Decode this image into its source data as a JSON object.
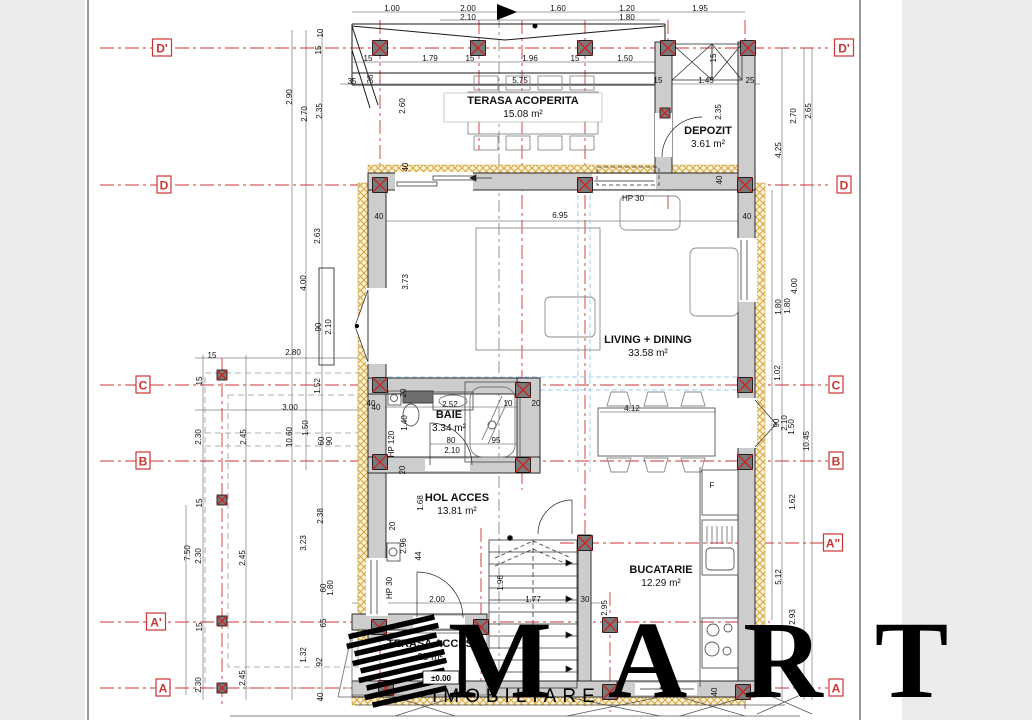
{
  "colors": {
    "grid_red": "#cc3333",
    "wall_gray": "#cdcdcd",
    "hatch_yellow": "#d9a33c",
    "hatch_bg": "#fdf3d6",
    "blue_dash": "#9fc8e8",
    "marker_fill": "#7a7a7a",
    "page_bg": "#ffffff",
    "margin_bg": "#ececec"
  },
  "watermark": {
    "title": "MART",
    "subtitle": "IMOBILIARE"
  },
  "level_marker": "±0.00",
  "grid_rows": [
    {
      "label": "D'",
      "y": 48,
      "x1": 100,
      "x2": 828,
      "lx": 162,
      "rx": 844
    },
    {
      "label": "D",
      "y": 185,
      "x1": 100,
      "x2": 828,
      "lx": 164,
      "rx": 844
    },
    {
      "label": "C",
      "y": 385,
      "x1": 100,
      "x2": 828,
      "lx": 143,
      "rx": 836
    },
    {
      "label": "B",
      "y": 461,
      "x1": 100,
      "x2": 828,
      "lx": 143,
      "rx": 836
    },
    {
      "label": "A\"",
      "y": 543,
      "x1": 560,
      "x2": 828,
      "lx": null,
      "rx": 833
    },
    {
      "label": "A'",
      "y": 622,
      "x1": 100,
      "x2": 770,
      "lx": 156,
      "rx": null
    },
    {
      "label": "A",
      "y": 688,
      "x1": 100,
      "x2": 828,
      "lx": 163,
      "rx": 836
    }
  ],
  "grid_cols": [
    {
      "x": 222,
      "y1": 358,
      "y2": 706
    },
    {
      "x": 380,
      "y1": 20,
      "y2": 706
    },
    {
      "x": 479,
      "y1": 20,
      "y2": 150
    },
    {
      "x": 481,
      "y1": 528,
      "y2": 706
    },
    {
      "x": 522,
      "y1": 20,
      "y2": 490
    },
    {
      "x": 585,
      "y1": 20,
      "y2": 706
    },
    {
      "x": 610,
      "y1": 592,
      "y2": 712
    },
    {
      "x": 668,
      "y1": 20,
      "y2": 210
    },
    {
      "x": 745,
      "y1": 20,
      "y2": 710
    }
  ],
  "rooms": [
    {
      "name": "TERASA ACOPERITA",
      "area": "15.08 m²",
      "x": 523,
      "y": 104
    },
    {
      "name": "DEPOZIT",
      "area": "3.61 m²",
      "x": 708,
      "y": 134
    },
    {
      "name": "LIVING + DINING",
      "area": "33.58 m²",
      "x": 648,
      "y": 343
    },
    {
      "name": "BAIE",
      "area": "3.34 m²",
      "x": 449,
      "y": 418
    },
    {
      "name": "HOL ACCES",
      "area": "13.81 m²",
      "x": 457,
      "y": 501
    },
    {
      "name": "BUCATARIE",
      "area": "12.29 m²",
      "x": 661,
      "y": 573
    },
    {
      "name": "TERASA ACCES",
      "area": "23 m²",
      "x": 430,
      "y": 647
    }
  ],
  "dimensions": [
    {
      "t": "1.00",
      "x": 392,
      "y": 8
    },
    {
      "t": "2.00",
      "x": 468,
      "y": 8
    },
    {
      "t": "2.10",
      "x": 468,
      "y": 17
    },
    {
      "t": "1.60",
      "x": 558,
      "y": 8
    },
    {
      "t": "1.20",
      "x": 627,
      "y": 8
    },
    {
      "t": "1.80",
      "x": 627,
      "y": 17
    },
    {
      "t": "1.95",
      "x": 700,
      "y": 8
    },
    {
      "t": "15",
      "x": 368,
      "y": 58
    },
    {
      "t": "1.79",
      "x": 430,
      "y": 58
    },
    {
      "t": "15",
      "x": 470,
      "y": 58
    },
    {
      "t": "1.96",
      "x": 530,
      "y": 58
    },
    {
      "t": "15",
      "x": 575,
      "y": 58
    },
    {
      "t": "1.50",
      "x": 625,
      "y": 58
    },
    {
      "t": "35",
      "x": 352,
      "y": 81
    },
    {
      "t": "5.75",
      "x": 520,
      "y": 80
    },
    {
      "t": "15",
      "x": 658,
      "y": 80
    },
    {
      "t": "1.45",
      "x": 706,
      "y": 80
    },
    {
      "t": "25",
      "x": 750,
      "y": 80
    },
    {
      "t": "10",
      "x": 320,
      "y": 33,
      "v": true
    },
    {
      "t": "15",
      "x": 318,
      "y": 50,
      "v": true
    },
    {
      "t": "2.90",
      "x": 289,
      "y": 97,
      "v": true
    },
    {
      "t": "2.70",
      "x": 304,
      "y": 114,
      "v": true
    },
    {
      "t": "2.35",
      "x": 319,
      "y": 111,
      "v": true
    },
    {
      "t": "2.60",
      "x": 402,
      "y": 106,
      "v": true
    },
    {
      "t": "36",
      "x": 370,
      "y": 79,
      "v": true
    },
    {
      "t": "40",
      "x": 405,
      "y": 167,
      "v": true
    },
    {
      "t": "2.63",
      "x": 317,
      "y": 236,
      "v": true
    },
    {
      "t": "4.00",
      "x": 303,
      "y": 283,
      "v": true
    },
    {
      "t": "3.73",
      "x": 405,
      "y": 282,
      "v": true
    },
    {
      "t": "90",
      "x": 318,
      "y": 327,
      "v": true
    },
    {
      "t": "2.10",
      "x": 328,
      "y": 327,
      "v": true
    },
    {
      "t": "2.80",
      "x": 293,
      "y": 352
    },
    {
      "t": "1.52",
      "x": 317,
      "y": 386,
      "v": true
    },
    {
      "t": "15",
      "x": 212,
      "y": 355
    },
    {
      "t": "15",
      "x": 199,
      "y": 381,
      "v": true
    },
    {
      "t": "3.00",
      "x": 290,
      "y": 407
    },
    {
      "t": "40",
      "x": 376,
      "y": 407
    },
    {
      "t": "2.30",
      "x": 198,
      "y": 437,
      "v": true
    },
    {
      "t": "2.45",
      "x": 243,
      "y": 437,
      "v": true
    },
    {
      "t": "1.50",
      "x": 305,
      "y": 428,
      "v": true
    },
    {
      "t": "10.60",
      "x": 289,
      "y": 437,
      "v": true
    },
    {
      "t": "60",
      "x": 321,
      "y": 441,
      "v": true
    },
    {
      "t": "90",
      "x": 329,
      "y": 441,
      "v": true
    },
    {
      "t": "15",
      "x": 199,
      "y": 503,
      "v": true
    },
    {
      "t": "2.38",
      "x": 320,
      "y": 516,
      "v": true
    },
    {
      "t": "7.50",
      "x": 187,
      "y": 553,
      "v": true
    },
    {
      "t": "2.30",
      "x": 198,
      "y": 556,
      "v": true
    },
    {
      "t": "2.45",
      "x": 242,
      "y": 558,
      "v": true
    },
    {
      "t": "3.23",
      "x": 303,
      "y": 543,
      "v": true
    },
    {
      "t": "60",
      "x": 323,
      "y": 588,
      "v": true
    },
    {
      "t": "1.80",
      "x": 330,
      "y": 588,
      "v": true
    },
    {
      "t": "65",
      "x": 323,
      "y": 623,
      "v": true
    },
    {
      "t": "15",
      "x": 199,
      "y": 627,
      "v": true
    },
    {
      "t": "1.32",
      "x": 303,
      "y": 655,
      "v": true
    },
    {
      "t": "92",
      "x": 319,
      "y": 662,
      "v": true
    },
    {
      "t": "2.30",
      "x": 198,
      "y": 685,
      "v": true
    },
    {
      "t": "2.45",
      "x": 242,
      "y": 678,
      "v": true
    },
    {
      "t": "40",
      "x": 320,
      "y": 697,
      "v": true
    },
    {
      "t": "40",
      "x": 379,
      "y": 216
    },
    {
      "t": "6.95",
      "x": 560,
      "y": 215
    },
    {
      "t": "HP 30",
      "x": 633,
      "y": 198
    },
    {
      "t": "40",
      "x": 719,
      "y": 180,
      "v": true
    },
    {
      "t": "40",
      "x": 747,
      "y": 216
    },
    {
      "t": "15",
      "x": 713,
      "y": 58,
      "v": true
    },
    {
      "t": "2.35",
      "x": 718,
      "y": 112,
      "v": true
    },
    {
      "t": "4.25",
      "x": 778,
      "y": 150,
      "v": true
    },
    {
      "t": "2.70",
      "x": 793,
      "y": 116,
      "v": true
    },
    {
      "t": "2.65",
      "x": 808,
      "y": 111,
      "v": true
    },
    {
      "t": "1.80",
      "x": 778,
      "y": 307,
      "v": true
    },
    {
      "t": "1.80",
      "x": 787,
      "y": 306,
      "v": true
    },
    {
      "t": "4.00",
      "x": 794,
      "y": 286,
      "v": true
    },
    {
      "t": "1.02",
      "x": 777,
      "y": 373,
      "v": true
    },
    {
      "t": "90",
      "x": 776,
      "y": 423,
      "v": true
    },
    {
      "t": "2.10",
      "x": 784,
      "y": 423,
      "v": true
    },
    {
      "t": "1.50",
      "x": 791,
      "y": 427,
      "v": true
    },
    {
      "t": "10.45",
      "x": 806,
      "y": 441,
      "v": true
    },
    {
      "t": "1.62",
      "x": 792,
      "y": 502,
      "v": true
    },
    {
      "t": "5.12",
      "x": 778,
      "y": 577,
      "v": true
    },
    {
      "t": "2.93",
      "x": 792,
      "y": 617,
      "v": true
    },
    {
      "t": "40",
      "x": 714,
      "y": 692,
      "v": true
    },
    {
      "t": "40",
      "x": 371,
      "y": 403
    },
    {
      "t": "20",
      "x": 403,
      "y": 393,
      "v": true
    },
    {
      "t": "2.52",
      "x": 450,
      "y": 404
    },
    {
      "t": "10",
      "x": 508,
      "y": 403
    },
    {
      "t": "20",
      "x": 536,
      "y": 403
    },
    {
      "t": "1.40",
      "x": 404,
      "y": 423,
      "v": true
    },
    {
      "t": "HP 120",
      "x": 391,
      "y": 444,
      "v": true
    },
    {
      "t": "80",
      "x": 451,
      "y": 440
    },
    {
      "t": "2.10",
      "x": 452,
      "y": 450
    },
    {
      "t": "95",
      "x": 496,
      "y": 440
    },
    {
      "t": "20",
      "x": 402,
      "y": 470,
      "v": true
    },
    {
      "t": "1.68",
      "x": 420,
      "y": 503,
      "v": true
    },
    {
      "t": "20",
      "x": 392,
      "y": 526,
      "v": true
    },
    {
      "t": "2.96",
      "x": 403,
      "y": 546,
      "v": true
    },
    {
      "t": "44",
      "x": 418,
      "y": 556,
      "v": true
    },
    {
      "t": "1.96",
      "x": 500,
      "y": 583,
      "v": true
    },
    {
      "t": "2.00",
      "x": 437,
      "y": 599
    },
    {
      "t": "1.77",
      "x": 533,
      "y": 599
    },
    {
      "t": "30",
      "x": 585,
      "y": 599
    },
    {
      "t": "HP 30",
      "x": 389,
      "y": 588,
      "v": true
    },
    {
      "t": "2.95",
      "x": 604,
      "y": 608,
      "v": true
    },
    {
      "t": "4.12",
      "x": 632,
      "y": 408
    },
    {
      "t": "F",
      "x": 712,
      "y": 485
    }
  ]
}
